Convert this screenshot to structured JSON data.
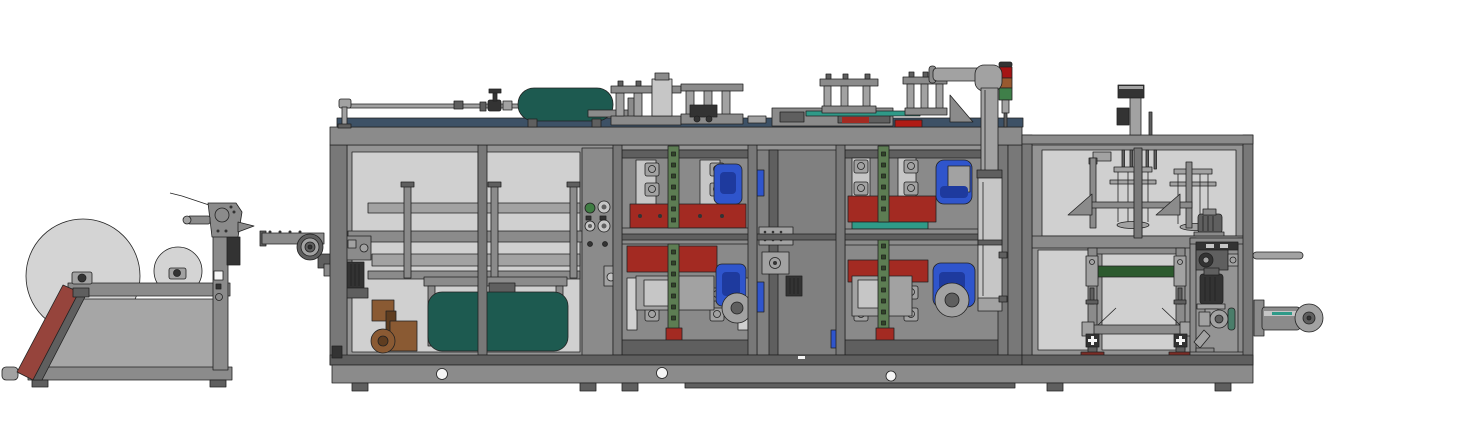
{
  "canvas": {
    "width": 1459,
    "height": 425
  },
  "scene_type": "cad-side-view-of-thermoforming-machine-line",
  "palette": {
    "bg": "#ffffff",
    "outline": "#222222",
    "frame": "#8b8b8b",
    "frameCol": "#787878",
    "frameDark": "#5f5f5f",
    "dark": "#333333",
    "metal": "#a2a2a2",
    "metalLight": "#c6c6c6",
    "panel": "#d0d0d0",
    "interior": "#949494",
    "stationBg": "#8a8a8a",
    "midBg": "#808080",
    "navy": "#3d5166",
    "tealTank": "#1d5a50",
    "tealBar": "#2f9a88",
    "tieGreen": "#5d7d53",
    "tieGreenDark": "#2f4527",
    "convGreen": "#2c5a2e",
    "red": "#a32a22",
    "redBright": "#b01b15",
    "rampRed": "#96443c",
    "blue": "#2f55cc",
    "blueDark": "#1e3a9e",
    "brown": "#8a5a33",
    "brownDark": "#5f3d20",
    "roll": "#d4d4d4",
    "rollStand": "#a6a6a6",
    "white": "#f5f5f5",
    "knobGreen": "#3f7d43",
    "stackRed": "#a51414",
    "stackAmber": "#99592f",
    "stackGreen": "#3f7f49",
    "footRed": "#7c2d26",
    "pumpTeal": "#4a7d6a"
  },
  "components": [
    "roll-unwinder",
    "film-roll-large",
    "film-roll-small",
    "discharge-ramp",
    "web-guide",
    "infeed-arm",
    "drive-wheel",
    "machine-frame",
    "roof-pipework",
    "air-tank",
    "pressure-valve",
    "roof-press-a1",
    "roof-press-a2",
    "roof-girder",
    "roof-press-b1",
    "roof-press-b2",
    "signal-tower",
    "exhaust-pipe",
    "left-compartment",
    "transport-rails",
    "inner-tank",
    "control-panel",
    "forming-station",
    "mid-compartment",
    "cutting-station",
    "right-cabinet",
    "stacking-unit",
    "stacker-motor",
    "conveyor-window",
    "pump-cabinet",
    "output-rod",
    "output-cylinder",
    "base-skid"
  ],
  "signal_tower_lights": [
    "red",
    "amber",
    "green"
  ]
}
